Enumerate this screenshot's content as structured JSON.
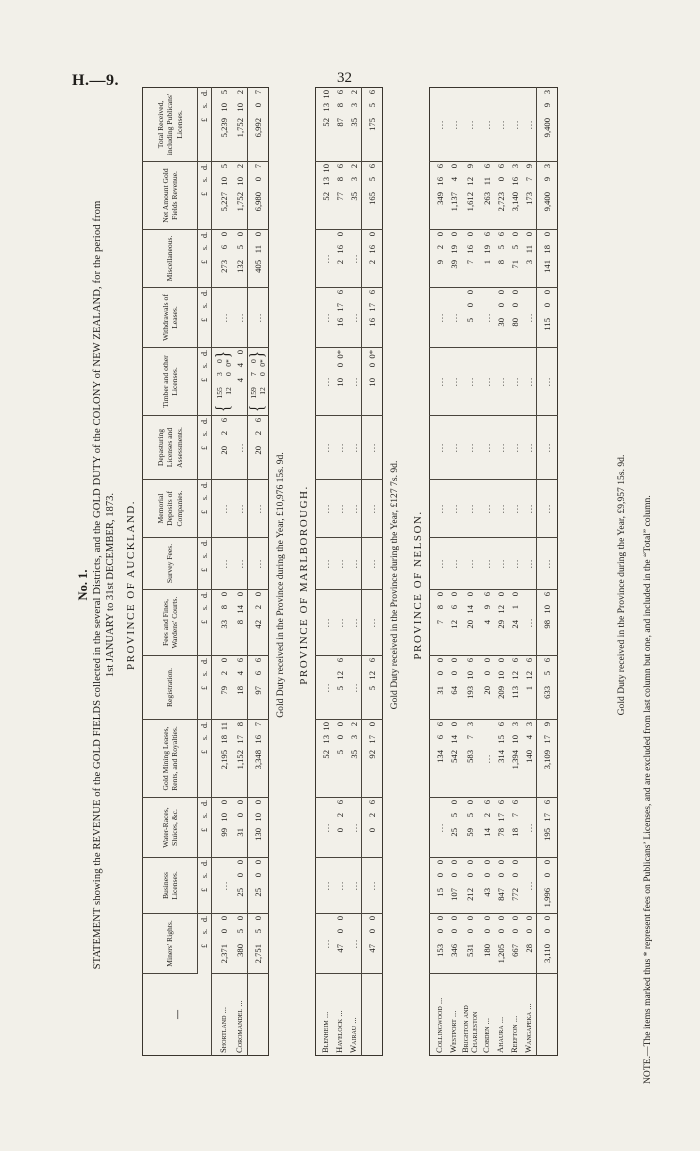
{
  "page": {
    "doc_ref": "H.—9.",
    "page_number": "32"
  },
  "statement": {
    "number": "No. 1.",
    "title_line1": "STATEMENT showing the REVENUE of the GOLD FIELDS collected in the several Districts, and the GOLD DUTY of the COLONY of NEW ZEALAND, for the period from",
    "title_line2": "1st JANUARY to 31st DECEMBER, 1873.",
    "note": "NOTE.—The items marked thus * represent fees on Publicans’ Licenses, and are excluded from last column but one, and included in the “Total” column."
  },
  "columns": {
    "name_header": "—",
    "money_subheader": "£ s. d.",
    "headers": [
      "Miners' Rights.",
      "Business Licenses.",
      "Water-Races, Sluices, &c.",
      "Gold Mining Leases, Rents, and Royalties.",
      "Registration.",
      "Fees and Fines, Wardens' Courts.",
      "Survey Fees.",
      "Memorial Deposits of Companies.",
      "Depasturing Licenses and Assessments.",
      "Timber and other Licenses.",
      "Withdrawals of Leases.",
      "Miscellaneous.",
      "Net Amount Gold Fields Revenue.",
      "Total Received, including Publicans' Licenses."
    ]
  },
  "sections": [
    {
      "heading": "PROVINCE OF AUCKLAND.",
      "has_header_row": true,
      "rows": [
        {
          "name": "Shortland ...",
          "cells": [
            "2,371 0 0",
            "...",
            "99 10 0",
            "2,195 18 11",
            "79 2 0",
            "33 8 0",
            "...",
            "...",
            "20 2 6",
            "{155 3 0|12 0 0*}",
            "...",
            "273 6 0",
            "5,227 10 5",
            "5,239 10 5"
          ]
        },
        {
          "name": "Coromandel ...",
          "cells": [
            "380 5 0",
            "25 0 0",
            "31 0 0",
            "1,152 17 8",
            "18 4 6",
            "8 14 0",
            "...",
            "...",
            "...",
            "4 4 0",
            "...",
            "132 5 0",
            "1,752 10 2",
            "1,752 10 2"
          ]
        }
      ],
      "totals": {
        "name": "",
        "cells": [
          "2,751 5 0",
          "25 0 0",
          "130 10 0",
          "3,348 16 7",
          "97 6 6",
          "42 2 0",
          "...",
          "...",
          "20 2 6",
          "{159 7 0|12 0 0*}",
          "...",
          "405 11 0",
          "6,980 0 7",
          "6,992 0 7"
        ]
      },
      "gold_duty": "Gold Duty received in the Province during the Year, £10,976 15s. 9d."
    },
    {
      "heading": "PROVINCE OF MARLBOROUGH.",
      "has_header_row": false,
      "rows": [
        {
          "name": "Blenheim ...",
          "cells": [
            "...",
            "...",
            "...",
            "52 13 10",
            "...",
            "...",
            "...",
            "...",
            "...",
            "...",
            "...",
            "...",
            "52 13 10",
            "52 13 10"
          ]
        },
        {
          "name": "Havelock ...",
          "cells": [
            "47 0 0",
            "...",
            "0 2 6",
            "5 0 0",
            "5 12 6",
            "...",
            "...",
            "...",
            "...",
            "10 0 0*",
            "16 17 6",
            "2 16 0",
            "77 8 6",
            "87 8 6"
          ]
        },
        {
          "name": "Wairau ...",
          "cells": [
            "...",
            "...",
            "...",
            "35 3 2",
            "...",
            "...",
            "...",
            "...",
            "...",
            "...",
            "...",
            "...",
            "35 3 2",
            "35 3 2"
          ]
        }
      ],
      "totals": {
        "name": "",
        "cells": [
          "47 0 0",
          "...",
          "0 2 6",
          "92 17 0",
          "5 12 6",
          "...",
          "...",
          "...",
          "...",
          "10 0 0*",
          "16 17 6",
          "2 16 0",
          "165 5 6",
          "175 5 6"
        ]
      },
      "gold_duty": "Gold Duty received in the Province during the Year, £127 7s. 9d."
    },
    {
      "heading": "PROVINCE OF NELSON.",
      "has_header_row": false,
      "rows": [
        {
          "name": "Collingwood ...",
          "cells": [
            "153 0 0",
            "15 0 0",
            "...",
            "134 6 6",
            "31 0 0",
            "7 8 0",
            "...",
            "...",
            "...",
            "...",
            "...",
            "9 2 0",
            "349 16 6",
            "..."
          ]
        },
        {
          "name": "Westport ...",
          "cells": [
            "346 0 0",
            "107 0 0",
            "25 5 0",
            "542 14 0",
            "64 0 0",
            "12 6 0",
            "...",
            "...",
            "...",
            "...",
            "...",
            "39 19 0",
            "1,137 4 0",
            "..."
          ]
        },
        {
          "name": "Brighton and Charleston",
          "cells": [
            "531 0 0",
            "212 0 0",
            "59 5 0",
            "583 7 3",
            "193 10 6",
            "20 14 0",
            "...",
            "...",
            "...",
            "...",
            "5 0 0",
            "7 16 0",
            "1,612 12 9",
            "..."
          ]
        },
        {
          "name": "Cobden ...",
          "cells": [
            "180 0 0",
            "43 0 0",
            "14 2 6",
            "...",
            "20 0 0",
            "4 9 6",
            "...",
            "...",
            "...",
            "...",
            "...",
            "1 19 6",
            "263 11 6",
            "..."
          ]
        },
        {
          "name": "Ahaura ...",
          "cells": [
            "1,205 0 0",
            "847 0 0",
            "78 17 6",
            "314 15 6",
            "209 10 0",
            "29 12 0",
            "...",
            "...",
            "...",
            "...",
            "30 0 0",
            "8 5 6",
            "2,723 0 6",
            "..."
          ]
        },
        {
          "name": "Reefton ...",
          "cells": [
            "667 0 0",
            "772 0 0",
            "18 7 6",
            "1,394 10 3",
            "113 12 6",
            "24 1 0",
            "...",
            "...",
            "...",
            "...",
            "80 0 0",
            "71 5 0",
            "3,140 16 3",
            "..."
          ]
        },
        {
          "name": "Wangapeka ...",
          "cells": [
            "28 0 0",
            "...",
            "...",
            "140 4 3",
            "1 12 6",
            "...",
            "...",
            "...",
            "...",
            "...",
            "...",
            "3 11 0",
            "173 7 9",
            "..."
          ]
        }
      ],
      "totals": {
        "name": "",
        "cells": [
          "3,110 0 0",
          "1,996 0 0",
          "195 17 6",
          "3,109 17 9",
          "633 5 6",
          "98 10 6",
          "...",
          "...",
          "...",
          "...",
          "115 0 0",
          "141 18 0",
          "9,400 9 3",
          "9,400 9 3"
        ]
      },
      "gold_duty": "Gold Duty received in the Province during the Year, £9,957 15s. 9d."
    }
  ],
  "layout": {
    "col_widths": [
      82,
      60,
      56,
      60,
      78,
      64,
      66,
      52,
      58,
      64,
      68,
      60,
      58,
      68,
      74
    ],
    "ink_color": "#1f1d1a",
    "paper_color": "#f2f0e9"
  }
}
